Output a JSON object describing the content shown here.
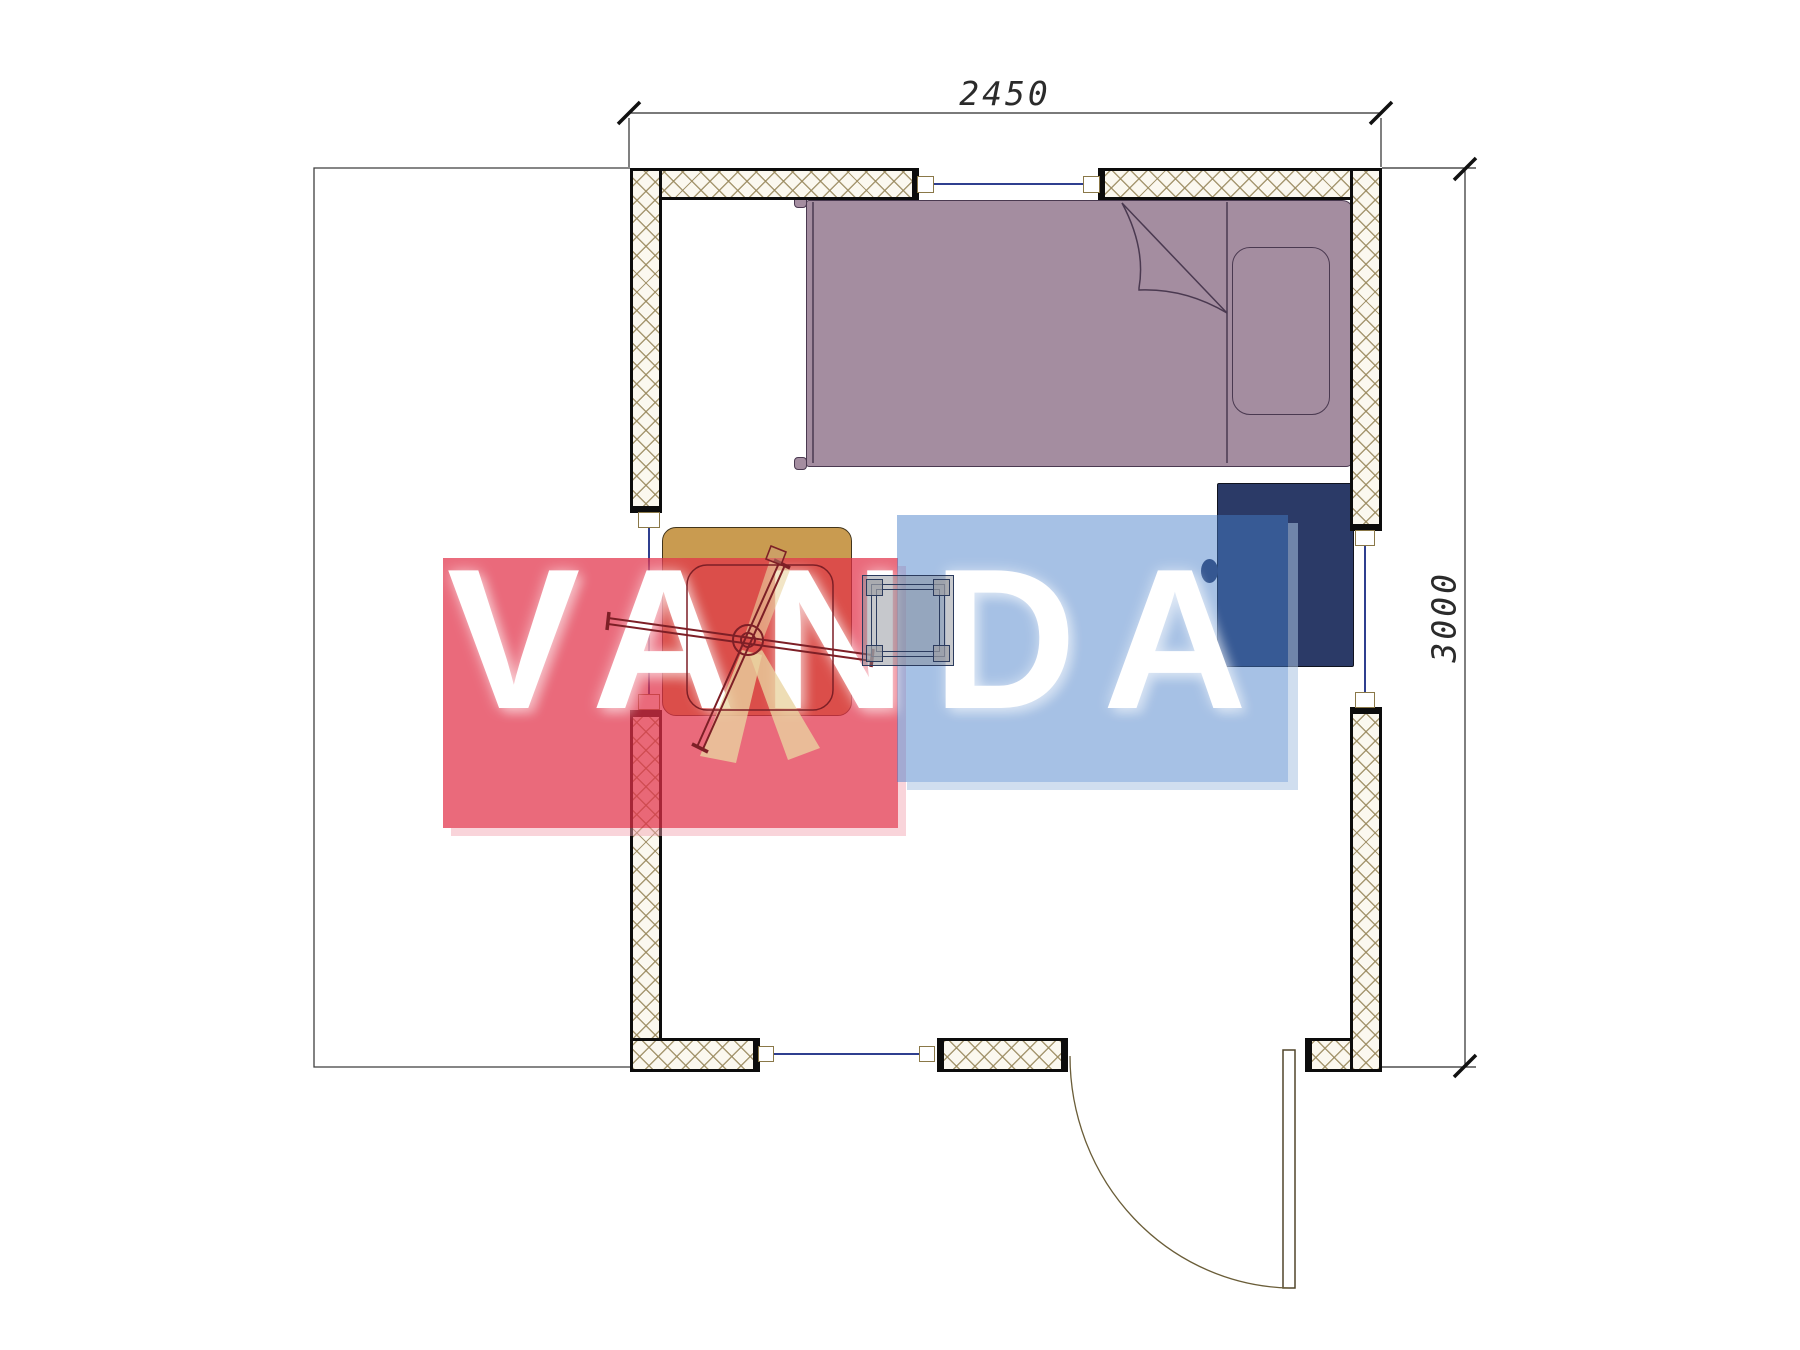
{
  "plan": {
    "watermark_text": "VANDA",
    "dim_width_label": "2450",
    "dim_height_label": "3000"
  },
  "colors": {
    "wall_fill": "#fbf8ef",
    "wall_hatch": "#98885c",
    "wall_border": "#0c0c0c",
    "bed_fill": "#a48da0",
    "bed_outline": "#4a3950",
    "pillow_fill": "#a48da0",
    "wardrobe_fill": "#2b3a67",
    "table_fill": "#c99b50",
    "chair_line": "#7d1f26",
    "chair_shade": "#e9d4a0",
    "stool_line": "#2b3b5e",
    "window_line": "#2f3f8f",
    "window_box_outline": "#8a7848",
    "door_line": "#6a5d38",
    "dimension_line": "#2b2b2b",
    "watermark_red": "#e23048",
    "watermark_blue": "#4a7dc8",
    "watermark_text_color": "#ffffff"
  }
}
